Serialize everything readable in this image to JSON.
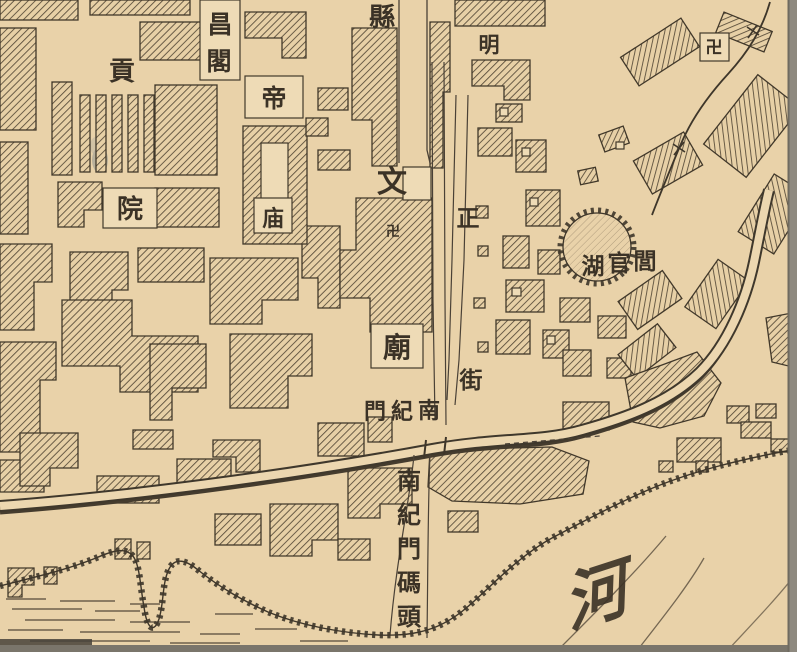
{
  "map": {
    "type": "historical-city-map",
    "colors": {
      "paper": "#e9d2a9",
      "paper_light": "#eedbb6",
      "ink": "#3e362a",
      "hatch": "#544836",
      "scan_edge_gray": "#8e897f",
      "water_ink": "#574c3c"
    },
    "labels": {
      "gongyuan": {
        "name": "貢院",
        "chars": [
          "貢",
          "院"
        ]
      },
      "wenchangge": {
        "name": "昌閣",
        "chars": [
          "昌",
          "閣"
        ]
      },
      "dimiao": {
        "name": "帝庙",
        "chars": [
          "帝",
          "庙"
        ]
      },
      "street_xianzheng": {
        "name": "縣正街",
        "chars": [
          "縣",
          "正",
          "街"
        ]
      },
      "wenmiao": {
        "name": "文廟",
        "chars": [
          "文",
          "廟"
        ]
      },
      "ming": {
        "char": "明"
      },
      "temple_mark": {
        "char": "卍"
      },
      "nanjimen": {
        "name": "南紀門",
        "display_rtl": [
          "門",
          "紀",
          "南"
        ]
      },
      "lake": {
        "name": "閭官湖",
        "display_rtl": [
          "湖",
          "官",
          "閭"
        ]
      },
      "wharf": {
        "name": "南紀門碼頭",
        "chars": [
          "南",
          "紀",
          "門",
          "碼",
          "頭"
        ]
      },
      "river": {
        "char": "河"
      }
    }
  }
}
